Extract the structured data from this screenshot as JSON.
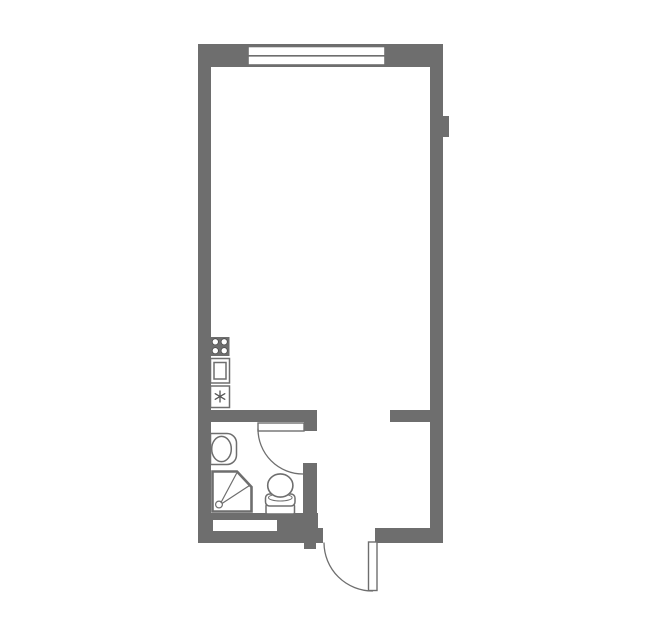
{
  "document": {
    "kind": "apartment-floor-plan",
    "description": "Studio apartment floor plan: main room with window at top, kitchen fixtures along left wall, bathroom with sink/shower/toilet at bottom-left, entry hall at bottom-right with swing door"
  },
  "canvas": {
    "width": 659,
    "height": 633,
    "background": "#ffffff"
  },
  "colors": {
    "wall": "#6e6e6e",
    "outline": "#6e6e6e",
    "fixture_fill": "#ffffff",
    "burner_ring": "#4a4a4a",
    "symbol": "#555555"
  },
  "shapes": [
    {
      "type": "rect",
      "name": "top-wall",
      "x": 198,
      "y": 44,
      "w": 245,
      "h": 23
    },
    {
      "type": "rect",
      "name": "left-wall",
      "x": 198,
      "y": 44,
      "w": 13,
      "h": 499
    },
    {
      "type": "rect",
      "name": "right-wall",
      "x": 430,
      "y": 44,
      "w": 13,
      "h": 499
    },
    {
      "type": "rect",
      "name": "right-wall-ledge",
      "x": 443,
      "y": 116,
      "w": 6,
      "h": 21
    },
    {
      "type": "rect",
      "name": "interior-wall-left",
      "x": 198,
      "y": 410,
      "w": 117,
      "h": 12
    },
    {
      "type": "rect",
      "name": "bath-door-jamb",
      "x": 304,
      "y": 410,
      "w": 13,
      "h": 21
    },
    {
      "type": "rect",
      "name": "interior-wall-right",
      "x": 390,
      "y": 410,
      "w": 53,
      "h": 12
    },
    {
      "type": "rect",
      "name": "bath-hall-divider-wall",
      "x": 303,
      "y": 463,
      "w": 14,
      "h": 52
    },
    {
      "type": "rect",
      "name": "bath-bottom-wall",
      "x": 198,
      "y": 513,
      "w": 120,
      "h": 30
    },
    {
      "type": "rect",
      "name": "bath-bottom-step",
      "x": 317,
      "y": 528,
      "w": 6,
      "h": 15
    },
    {
      "type": "rect",
      "name": "entry-door-tab",
      "x": 304,
      "y": 543,
      "w": 12,
      "h": 6
    },
    {
      "type": "rect",
      "name": "entry-right-wall",
      "x": 375,
      "y": 528,
      "w": 68,
      "h": 15
    },
    {
      "type": "rect",
      "name": "wall-niche",
      "x": 213,
      "y": 520,
      "w": 64,
      "h": 11,
      "fill": "#ffffff"
    },
    {
      "type": "rect",
      "name": "window",
      "x": 248,
      "y": 46.5,
      "w": 137,
      "h": 18.5,
      "fill": "#ffffff",
      "sw": 1.6
    },
    {
      "type": "line",
      "name": "window-divider",
      "x1": 248,
      "y1": 55.8,
      "x2": 385,
      "y2": 55.8,
      "sw": 1.6
    },
    {
      "type": "rect",
      "name": "bath-door-leaf",
      "x": 258,
      "y": 423,
      "w": 46,
      "h": 8,
      "fill": "#ffffff",
      "sw": 1.4
    },
    {
      "type": "path",
      "name": "bath-door-swing-arc",
      "d": "M258,429 A45,45 0 0 0 303,474",
      "fill": "none",
      "sw": 1.3
    },
    {
      "type": "rect",
      "name": "entry-door-leaf",
      "x": 368.5,
      "y": 542,
      "w": 8.5,
      "h": 48.5,
      "fill": "#ffffff",
      "sw": 1.4
    },
    {
      "type": "path",
      "name": "entry-door-swing-arc",
      "d": "M324,543 A48.5,48.5 0 0 0 372.5,591",
      "fill": "none",
      "sw": 1.3
    },
    {
      "type": "rect",
      "name": "stove-body",
      "x": 210.5,
      "y": 337,
      "w": 19,
      "h": 19
    },
    {
      "type": "circle",
      "name": "stove-burner",
      "cx": 215.3,
      "cy": 341.8,
      "r": 3.1,
      "fill": "#ffffff",
      "stroke": "#4a4a4a",
      "sw": 0.8
    },
    {
      "type": "circle",
      "name": "stove-burner",
      "cx": 224.2,
      "cy": 341.8,
      "r": 3.1,
      "fill": "#ffffff",
      "stroke": "#4a4a4a",
      "sw": 0.8
    },
    {
      "type": "circle",
      "name": "stove-burner",
      "cx": 215.3,
      "cy": 350.7,
      "r": 3.1,
      "fill": "#ffffff",
      "stroke": "#4a4a4a",
      "sw": 0.8
    },
    {
      "type": "circle",
      "name": "stove-burner",
      "cx": 224.2,
      "cy": 350.7,
      "r": 3.1,
      "fill": "#ffffff",
      "stroke": "#4a4a4a",
      "sw": 0.8
    },
    {
      "type": "rect",
      "name": "kitchen-sink-outer",
      "x": 210.5,
      "y": 358.5,
      "w": 19,
      "h": 24.5,
      "fill": "#ffffff",
      "sw": 1.5
    },
    {
      "type": "rect",
      "name": "kitchen-sink-basin",
      "x": 214,
      "y": 362.5,
      "w": 12,
      "h": 16.5,
      "fill": "none",
      "sw": 1.5
    },
    {
      "type": "rect",
      "name": "washing-machine-box",
      "x": 210.5,
      "y": 386,
      "w": 19,
      "h": 21.5,
      "fill": "#ffffff",
      "sw": 1.5
    },
    {
      "type": "line",
      "name": "washer-asterisk-line",
      "x1": 220,
      "y1": 391,
      "x2": 220,
      "y2": 402,
      "stroke": "#555555",
      "sw": 1.3
    },
    {
      "type": "line",
      "name": "washer-asterisk-line",
      "x1": 215.2,
      "y1": 393.7,
      "x2": 224.8,
      "y2": 399.3,
      "stroke": "#555555",
      "sw": 1.3
    },
    {
      "type": "line",
      "name": "washer-asterisk-line",
      "x1": 215.2,
      "y1": 399.3,
      "x2": 224.8,
      "y2": 393.7,
      "stroke": "#555555",
      "sw": 1.3
    },
    {
      "type": "path",
      "name": "bath-sink-counter",
      "d": "M210.5,433.5 H227 A9.5,9.5 0 0 1 236.5,443 V455 A9.5,9.5 0 0 1 227,464.5 H210.5 Z",
      "fill": "#ffffff",
      "sw": 1.5
    },
    {
      "type": "ellipse",
      "name": "bath-sink-basin",
      "cx": 221.5,
      "cy": 449,
      "rx": 9.8,
      "ry": 12.6,
      "fill": "#ffffff",
      "sw": 1.5
    },
    {
      "type": "path",
      "name": "shower-tray",
      "d": "M212.5,471.5 H237 L251.5,487 V511.5 H212.5 Z",
      "fill": "#ffffff",
      "sw": 2.6
    },
    {
      "type": "circle",
      "name": "shower-drain",
      "cx": 219,
      "cy": 504.5,
      "r": 3.4,
      "fill": "#ffffff",
      "sw": 1.2
    },
    {
      "type": "line",
      "name": "shower-spray-line",
      "x1": 221,
      "y1": 502.5,
      "x2": 236.5,
      "y2": 473.5,
      "sw": 1.2
    },
    {
      "type": "line",
      "name": "shower-spray-line",
      "x1": 222,
      "y1": 503.5,
      "x2": 249.5,
      "y2": 485.5,
      "sw": 1.2
    },
    {
      "type": "rect",
      "name": "toilet-tank",
      "x": 266,
      "y": 504.5,
      "w": 28.5,
      "h": 9.5,
      "rx": 1.5,
      "fill": "#ffffff",
      "sw": 1.5
    },
    {
      "type": "rect",
      "name": "toilet-seat",
      "x": 265.5,
      "y": 494,
      "w": 29.5,
      "h": 12,
      "rx": 4,
      "fill": "#ffffff",
      "sw": 1.5
    },
    {
      "type": "ellipse",
      "name": "toilet-seat-ring",
      "cx": 280.3,
      "cy": 497.6,
      "rx": 11.8,
      "ry": 3.4,
      "fill": "#ffffff",
      "sw": 1
    },
    {
      "type": "ellipse",
      "name": "toilet-bowl",
      "cx": 280.3,
      "cy": 485.5,
      "rx": 12.6,
      "ry": 11.6,
      "fill": "#ffffff",
      "sw": 1.6
    }
  ]
}
